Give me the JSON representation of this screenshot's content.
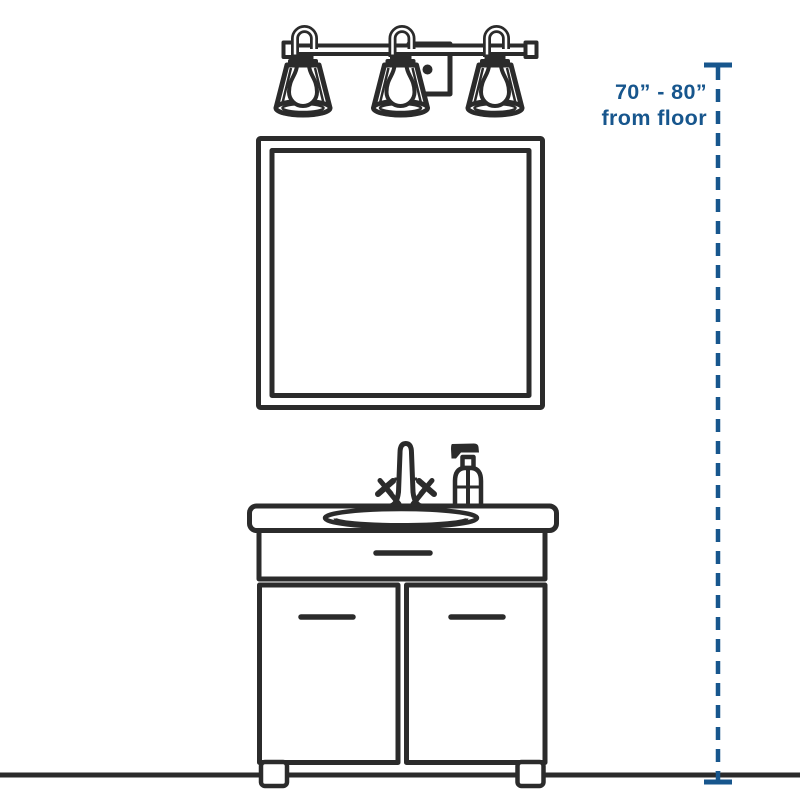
{
  "colors": {
    "ink": "#2b2b2b",
    "accent": "#17568d",
    "background": "#ffffff"
  },
  "annotation": {
    "line1": "70” - 80”",
    "line2": "from floor"
  },
  "icons": [
    "vanity-light-fixture-icon",
    "mirror-icon",
    "faucet-icon",
    "soap-dispenser-icon",
    "vanity-cabinet-icon",
    "sink-basin-icon",
    "floor-line",
    "height-dimension-line"
  ]
}
